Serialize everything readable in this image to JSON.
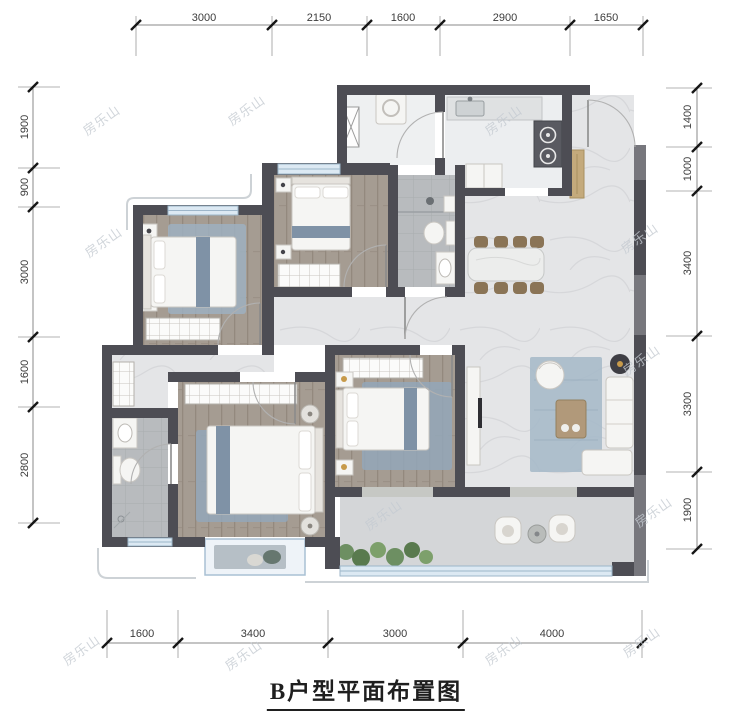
{
  "title": "B户型平面布置图",
  "watermark": "房乐山",
  "dimensions": {
    "top": [
      "3000",
      "2150",
      "1600",
      "2900",
      "1650"
    ],
    "bottom": [
      "1600",
      "3400",
      "3000",
      "4000"
    ],
    "left": [
      "1900",
      "900",
      "3000",
      "1600",
      "2800"
    ],
    "right": [
      "1400",
      "1000",
      "3400",
      "3300",
      "1900"
    ]
  },
  "colors": {
    "wall": "#4d4d54",
    "window_blue": "#dce9f3",
    "wood_floor": "#a59c92",
    "marble_floor": "#e4e5e7",
    "tile_floor": "#b8bbbe",
    "balcony_floor": "#d4d6d8",
    "rug_blue": "#93a7b8",
    "dining_chair": "#8a7456",
    "plant_green": "#6d8f62",
    "cabinet_tan": "#c4aa7c",
    "dim_text": "#3c3c3c",
    "watermark_gray": "#c5cbd2"
  }
}
